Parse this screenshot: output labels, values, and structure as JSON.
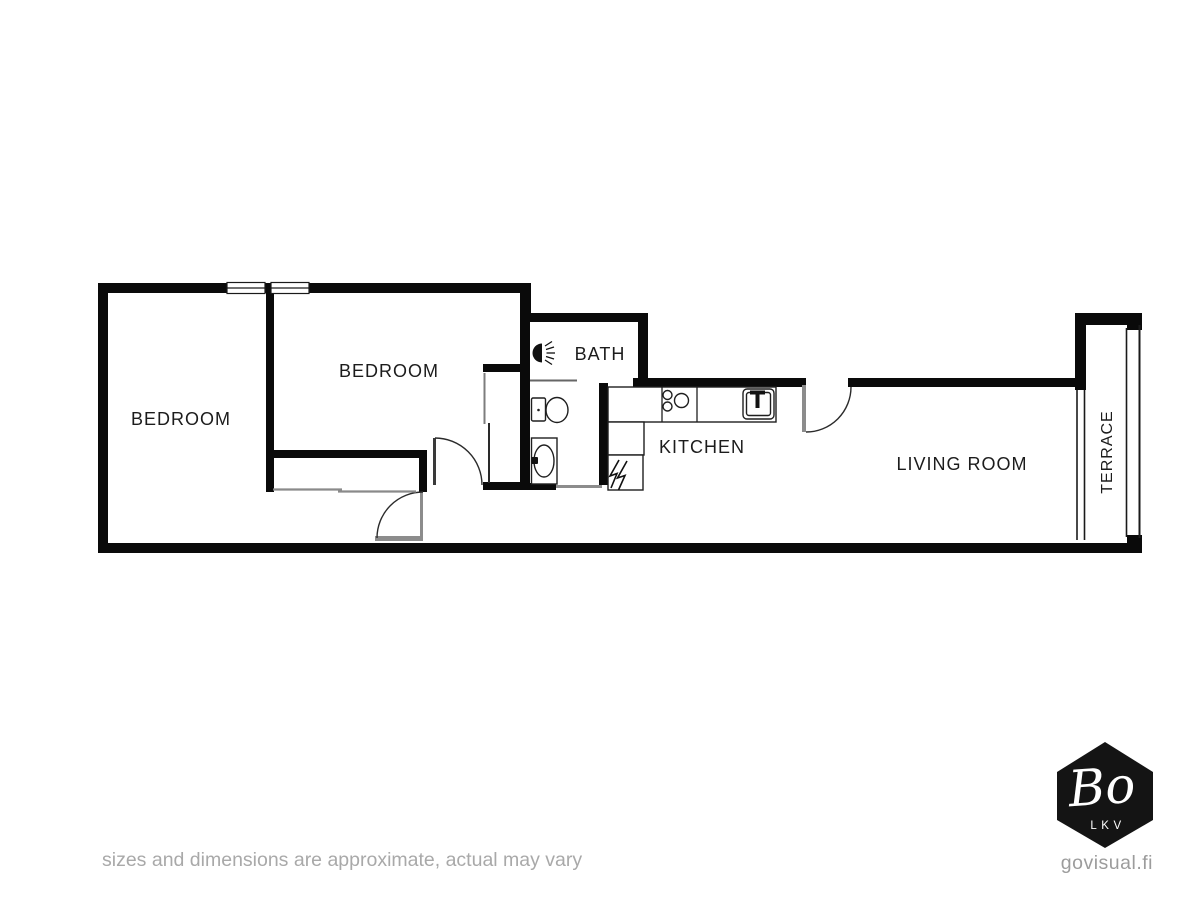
{
  "floorplan": {
    "rooms": {
      "bedroom1": {
        "label": "BEDROOM"
      },
      "bedroom2": {
        "label": "BEDROOM"
      },
      "bath": {
        "label": "BATH"
      },
      "kitchen": {
        "label": "KITCHEN"
      },
      "living": {
        "label": "LIVING ROOM"
      },
      "terrace": {
        "label": "TERRACE"
      }
    },
    "icons": {
      "shower": "shower-icon",
      "toilet": "toilet-icon",
      "sink": "sink-icon",
      "stove": "stove-icon",
      "kitchen_sink": "kitchen-sink-icon",
      "electrical_panel": "electrical-panel-icon"
    },
    "colors": {
      "wall": "#0a0a0a",
      "door_arc": "#2b2b2b",
      "threshold": "#8c8c8c",
      "label": "#1c1c1c"
    }
  },
  "footer": {
    "disclaimer": "sizes and dimensions are approximate, actual may vary"
  },
  "branding": {
    "logo_main": "Bo",
    "logo_sub": "LKV",
    "website": "govisual.fi",
    "logo_bg": "#141414"
  }
}
